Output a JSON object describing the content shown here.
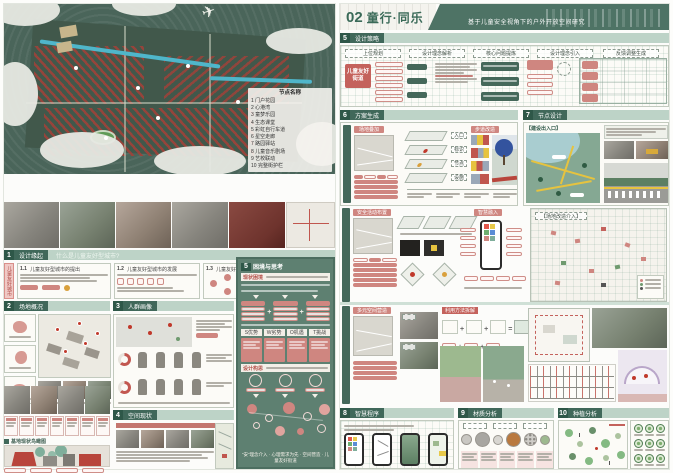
{
  "panels": {
    "left": {
      "number": "01",
      "title": "童行·同乐",
      "subtitle": "基于儿童安全视角下的户外开放空间研究"
    },
    "right": {
      "number": "02",
      "title": "童行·同乐",
      "subtitle": "基于儿童安全视角下的户外开放空间研究"
    }
  },
  "left": {
    "legend": {
      "title": "节点名称",
      "items": [
        "1 门户花园",
        "2 心港湾",
        "3 童梦乐园",
        "4 生态课堂",
        "5 彩虹自行车道",
        "6 星空走廊",
        "7 路园驿站",
        "8 儿童音乐剧场",
        "9 艺校联动",
        "10 完整街护栏"
      ]
    },
    "s1": {
      "num": "1",
      "title": "设计缘起",
      "question": "什么是儿童友好型城市?",
      "tab": "儿童友好城市",
      "cards": [
        {
          "no": "1.1",
          "title": "儿童友好型城市的提出"
        },
        {
          "no": "1.2",
          "title": "儿童友好型城市的发展"
        },
        {
          "no": "1.3",
          "title": "儿童友好型城市在中国"
        }
      ]
    },
    "s2": {
      "num": "2",
      "title": "场地概况"
    },
    "s3": {
      "num": "3",
      "title": "人群画像"
    },
    "s4": {
      "num": "4",
      "title": "空间现状"
    },
    "aerial_label": "基地现状鸟瞰图",
    "s5": {
      "num": "5",
      "title": "困境与思考",
      "block1": "现状困境",
      "swot": [
        "S优势",
        "W劣势",
        "O机遇",
        "T挑战"
      ],
      "block2": "设计构思",
      "caption": "“安”理念介入 · 心理需求为先 · 空间营造 · 儿童友好街道"
    }
  },
  "right": {
    "s5": {
      "num": "5",
      "title": "设计策略",
      "columns": [
        "上位规划",
        "设计理念解析",
        "核心问题提炼",
        "设计理念引入",
        "反馈调整生成"
      ],
      "key": "儿童友好街道"
    },
    "s6": {
      "num": "6",
      "title": "方案生成",
      "overlay": "场地叠加",
      "walk": "步道改造",
      "layers": [
        "入口",
        "标识",
        "节点",
        "设施"
      ]
    },
    "s7": {
      "num": "7",
      "title": "节点设计",
      "label": "【建设出入口】"
    },
    "mid": {
      "safety": "安全活动布置",
      "smart": "智慧融入",
      "plan": "【场地改造介入】"
    },
    "multi": {
      "label": "多元空间营造",
      "method": "利用方法拆解"
    },
    "s8": {
      "num": "8",
      "title": "智慧程序"
    },
    "s9": {
      "num": "9",
      "title": "材质分析"
    },
    "s10": {
      "num": "10",
      "title": "种植分析"
    }
  }
}
